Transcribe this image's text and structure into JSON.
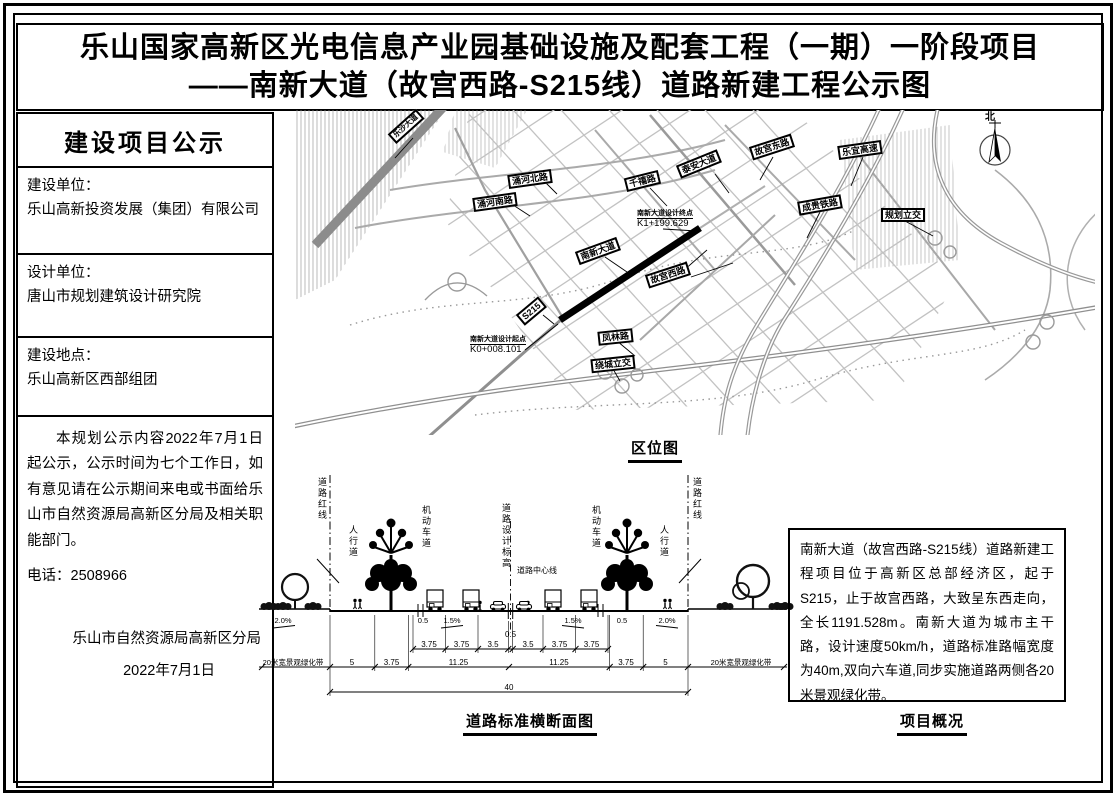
{
  "title": {
    "line1": "乐山国家高新区光电信息产业园基础设施及配套工程（一期）一阶段项目",
    "line2": "——南新大道（故宫西路-S215线）道路新建工程公示图"
  },
  "sidebar": {
    "header": "建设项目公示",
    "fields": [
      {
        "label": "建设单位：",
        "value": "乐山高新投资发展（集团）有限公司"
      },
      {
        "label": "设计单位：",
        "value": "唐山市规划建筑设计研究院"
      },
      {
        "label": "建设地点：",
        "value": "乐山高新区西部组团"
      }
    ],
    "notice": "本规划公示内容2022年7月1日起公示，公示时间为七个工作日，如有意见请在公示期间来电或书面给乐山市自然资源局高新区分局及相关职能部门。",
    "phone": "电话：2508966",
    "signature": "乐山市自然资源局高新区分局",
    "date": "2022年7月1日"
  },
  "map": {
    "caption": "区位图",
    "north_label": "北",
    "road_labels": [
      "乐沙大道",
      "涌河北路",
      "涌河南路",
      "千禧路",
      "泰安大道",
      "故宫东路",
      "乐宜高速",
      "成贵铁路",
      "规划立交",
      "南新大道",
      "故宫西路",
      "S215",
      "凤林路",
      "绕城立交"
    ],
    "end_point": {
      "line1": "南新大道设计终点",
      "line2": "K1+199.629"
    },
    "start_point": {
      "line1": "南新大道设计起点",
      "line2": "K0+008.101"
    }
  },
  "cross_section": {
    "caption": "道路标准横断面图",
    "red_line": "道路红线",
    "sidewalk": "人行道",
    "motor_lane": "机动车道",
    "design_elevation": "道路设计标高",
    "center_line": "道路中心线",
    "slopes": [
      "2.0%",
      "0.5",
      "1.5%",
      "1.5%",
      "0.5",
      "2.0%"
    ],
    "center_dim": "0.5",
    "lane_dims": [
      "3.75",
      "3.75",
      "3.5",
      "3.5",
      "3.75",
      "3.75"
    ],
    "zone_dims": [
      "5",
      "3.75",
      "11.25",
      "11.25",
      "3.75",
      "5"
    ],
    "green_belt": "20米宽景观绿化带",
    "total_width": "40"
  },
  "overview": {
    "caption": "项目概况",
    "text": "南新大道（故宫西路-S215线）道路新建工程项目位于高新区总部经济区，起于S215，止于故宫西路，大致呈东西走向，全长1191.528m。南新大道为城市主干路，设计速度50km/h，道路标准路幅宽度为40m,双向六车道,同步实施道路两侧各20米景观绿化带。"
  }
}
